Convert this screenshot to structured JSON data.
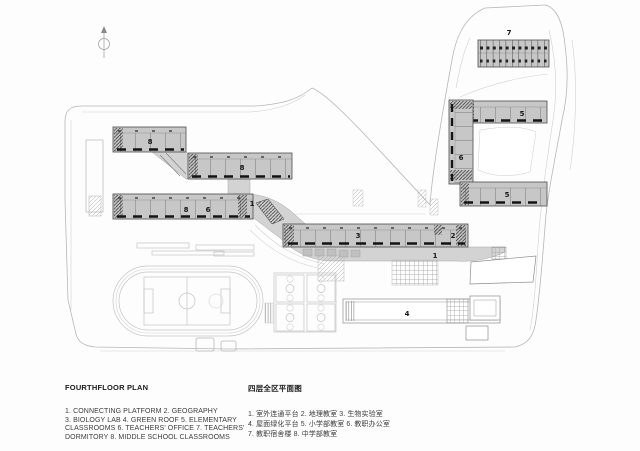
{
  "plan": {
    "title": "Fourth floor campus plan drawing",
    "north_arrow_icon": "north-arrow",
    "labels": {
      "bar_a": "8",
      "bar_b": "8",
      "bar_c_left": "8",
      "bar_c_right": "6",
      "platform_upper": "1",
      "bar_biology": "3",
      "bar_geography": "2",
      "platform_lower": "1",
      "green_roof": "4",
      "u_top": "5",
      "u_left": "6",
      "u_bottom": "5",
      "dormitory": "7"
    }
  },
  "legend_en": {
    "title": "FOURTHFLOOR PLAN",
    "lines": [
      "1. CONNECTING PLATFORM  2. GEOGRAPHY",
      "3. BIOLOGY LAB  4. GREEN ROOF  5. ELEMENTARY",
      "CLASSROOMS  6. TEACHERS' OFFICE  7. TEACHERS'",
      "DORMITORY  8. MIDDLE SCHOOL CLASSROOMS"
    ]
  },
  "legend_zh": {
    "title": "四层全区平面图",
    "lines": [
      "1. 室外连通平台  2. 地理教室  3. 生物实验室",
      "4. 屋面绿化平台  5. 小学部教室  6. 教职办公室",
      "7. 教职宿舍楼  8. 中学部教室"
    ]
  },
  "colors": {
    "building_fill": "#c7c7c7",
    "platform_fill": "#d3d3d3",
    "site_line": "#b7b7b7",
    "detail_dark": "#141414",
    "background": "#fdfdfd"
  }
}
